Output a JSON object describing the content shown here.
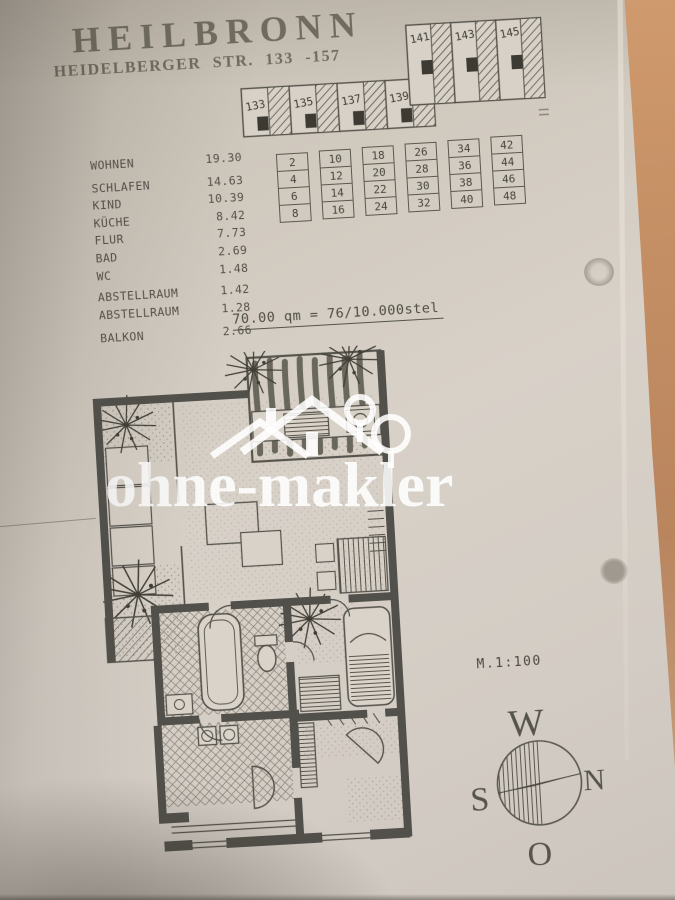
{
  "document": {
    "title": "HEILBRONN",
    "subtitle": "HEIDELBERGER STR. 133 -157",
    "total_line": "70.00 qm = 76/10.000stel",
    "scale_label": "M.1:100",
    "watermark": "ohne-makler"
  },
  "room_list": {
    "rows": [
      {
        "label": "WOHNEN",
        "value": "19.30"
      },
      {
        "label": "SCHLAFEN",
        "value": "14.63"
      },
      {
        "label": "KIND",
        "value": "10.39"
      },
      {
        "label": "KÜCHE",
        "value": "8.42"
      },
      {
        "label": "FLUR",
        "value": "7.73"
      },
      {
        "label": "BAD",
        "value": "2.69"
      },
      {
        "label": "WC",
        "value": "1.48"
      },
      {
        "label": "ABSTELLRAUM",
        "value": "1.42"
      },
      {
        "label": "ABSTELLRAUM",
        "value": "1.28"
      },
      {
        "label": "BALKON",
        "value": "2.66"
      }
    ]
  },
  "building_schematic": {
    "lower_units": [
      "133",
      "135",
      "137",
      "139"
    ],
    "upper_units": [
      "141",
      "143",
      "145"
    ]
  },
  "unit_grid": {
    "columns": [
      [
        "2",
        "4",
        "6",
        "8"
      ],
      [
        "10",
        "12",
        "14",
        "16"
      ],
      [
        "18",
        "20",
        "22",
        "24"
      ],
      [
        "26",
        "28",
        "30",
        "32"
      ],
      [
        "34",
        "36",
        "38",
        "40"
      ],
      [
        "42",
        "44",
        "46",
        "48"
      ]
    ]
  },
  "compass": {
    "west": "W",
    "north": "N",
    "south": "S",
    "east": "O"
  },
  "colors": {
    "paper": "#d5cec5",
    "ink": "#52504a",
    "wood": "#c08a62",
    "watermark_white": "#ffffff"
  }
}
